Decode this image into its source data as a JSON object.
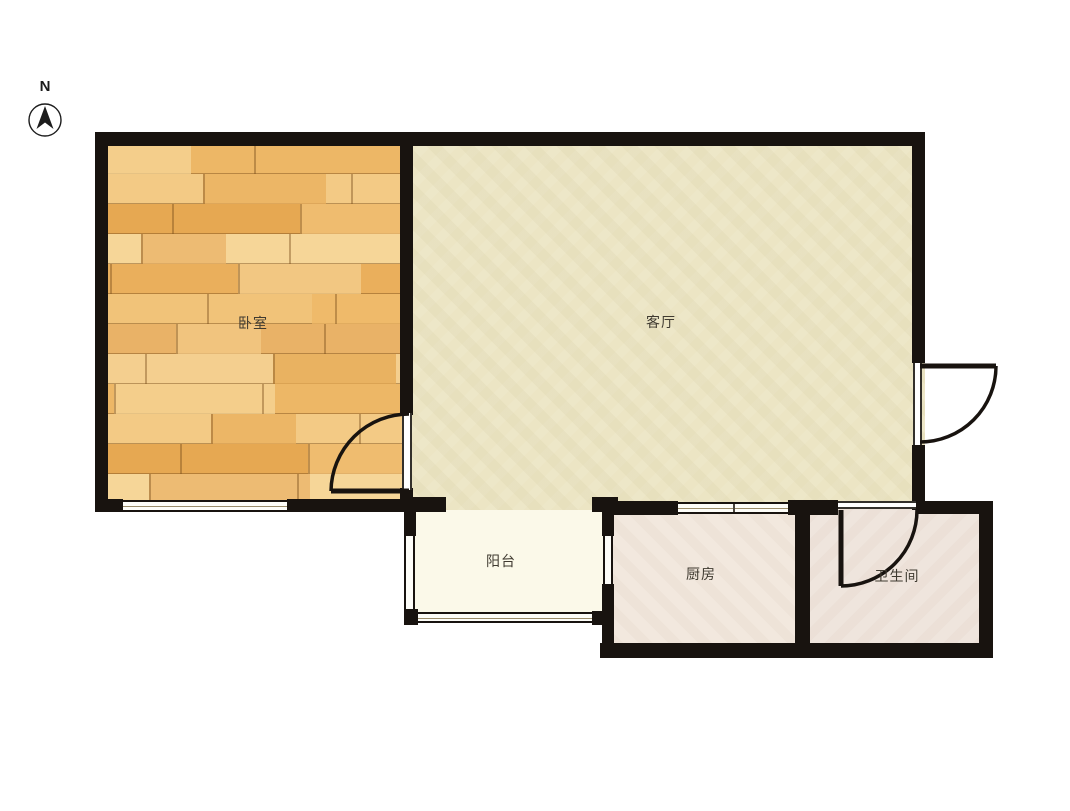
{
  "compass": {
    "label": "N"
  },
  "rooms": [
    {
      "id": "bedroom",
      "label": "卧室"
    },
    {
      "id": "living-room",
      "label": "客厅"
    },
    {
      "id": "balcony",
      "label": "阳台"
    },
    {
      "id": "kitchen",
      "label": "厨房"
    },
    {
      "id": "bathroom",
      "label": "卫生间"
    }
  ],
  "colors": {
    "wall": "#18130f",
    "bedroom_floor_wood": "#eeb968",
    "living_floor": "#ece5c4",
    "balcony_floor": "#fbf9e9",
    "kitchen_floor": "#f2e8de",
    "bathroom_floor": "#efe5dd",
    "label_text": "#3f3a30"
  }
}
